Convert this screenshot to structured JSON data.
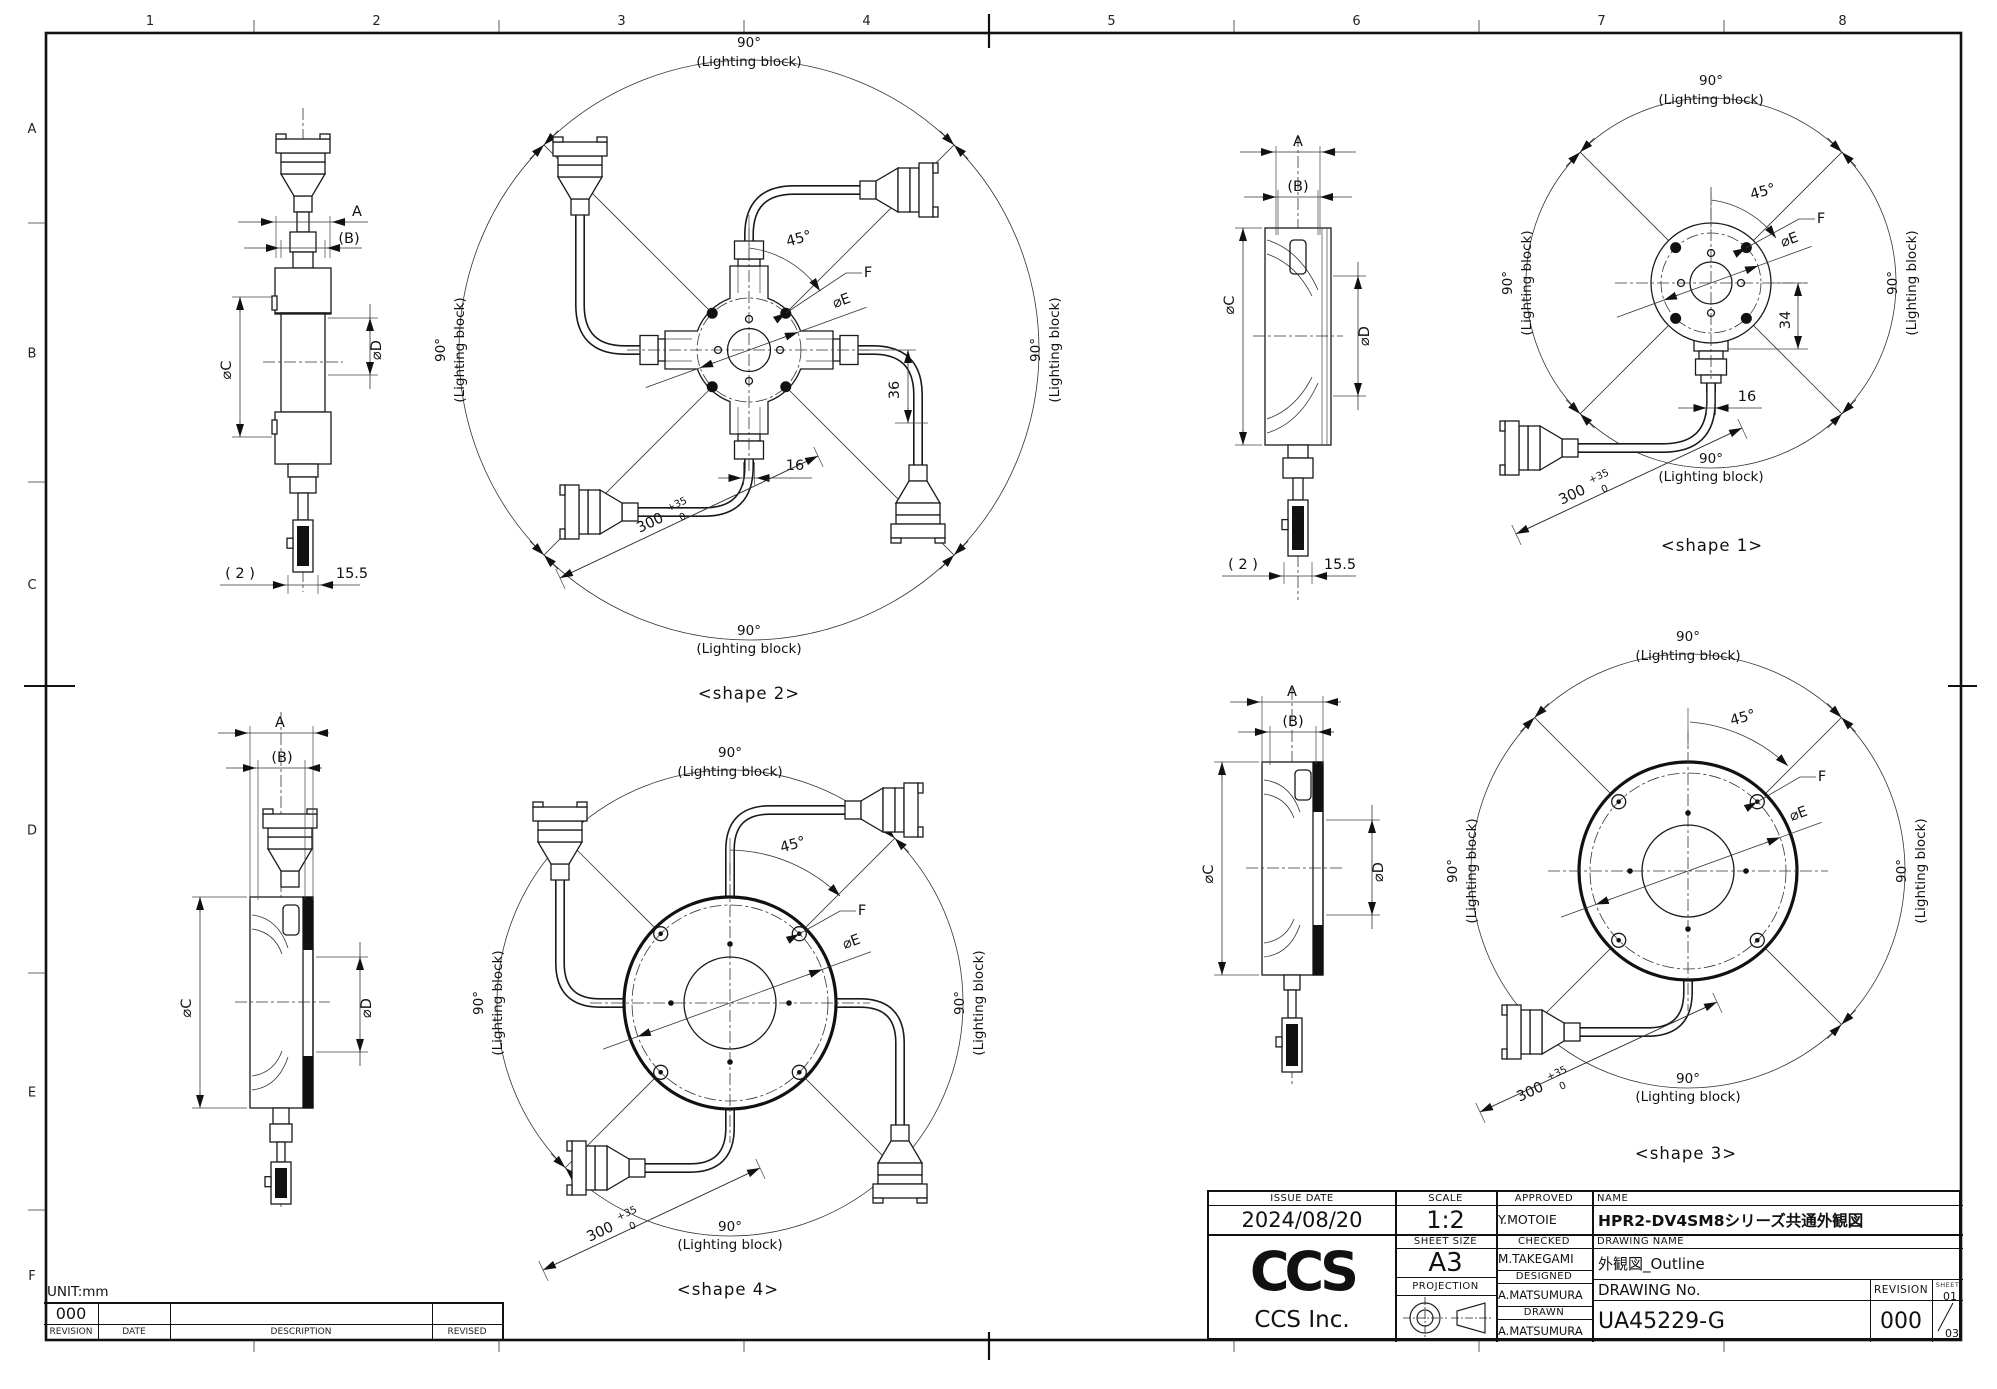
{
  "sheet": {
    "unit": "UNIT:mm",
    "columns": [
      "1",
      "2",
      "3",
      "4",
      "5",
      "6",
      "7",
      "8"
    ],
    "rows": [
      "A",
      "B",
      "C",
      "D",
      "E",
      "F"
    ]
  },
  "dims": {
    "angle_90": "90°",
    "lighting_block": "(Lighting block)",
    "angle_45": "45°",
    "hole_ref": "F",
    "dia_e": "⌀E",
    "width_a": "A",
    "width_b": "(B)",
    "dia_c": "⌀C",
    "dia_d": "⌀D",
    "cable_len": "300",
    "cable_tol_plus": "+35",
    "cable_tol_minus": "0",
    "dim_16": "16",
    "dim_36": "36",
    "dim_34": "34",
    "dim_2": "( 2 )",
    "dim_15_5": "15.5"
  },
  "captions": {
    "shape1": "<shape 1>",
    "shape2": "<shape 2>",
    "shape3": "<shape 3>",
    "shape4": "<shape 4>"
  },
  "revision_table": {
    "revision_value": "000",
    "revision_label": "REVISION",
    "date_label": "DATE",
    "description_label": "DESCRIPTION",
    "revised_label": "REVISED"
  },
  "title_block": {
    "issue_date_label": "ISSUE DATE",
    "issue_date": "2024/08/20",
    "scale_label": "SCALE",
    "scale": "1:2",
    "approved_label": "APPROVED",
    "approved": "Y.MOTOIE",
    "name_label": "NAME",
    "name": "HPR2-DV4SM8シリーズ共通外観図",
    "sheet_size_label": "SHEET SIZE",
    "sheet_size": "A3",
    "checked_label": "CHECKED",
    "checked": "M.TAKEGAMI",
    "drawing_name_label": "DRAWING NAME",
    "drawing_name": "外観図_Outline",
    "designed_label": "DESIGNED",
    "designed": "A.MATSUMURA",
    "projection_label": "PROJECTION",
    "drawn_label": "DRAWN",
    "drawn": "A.MATSUMURA",
    "drawing_no_label": "DRAWING No.",
    "drawing_no": "UA45229-G",
    "revision_label": "REVISION",
    "revision": "000",
    "sheet_label": "SHEET",
    "sheet_current": "01",
    "sheet_total": "03",
    "logo_text": "CCS",
    "company": "CCS Inc."
  }
}
